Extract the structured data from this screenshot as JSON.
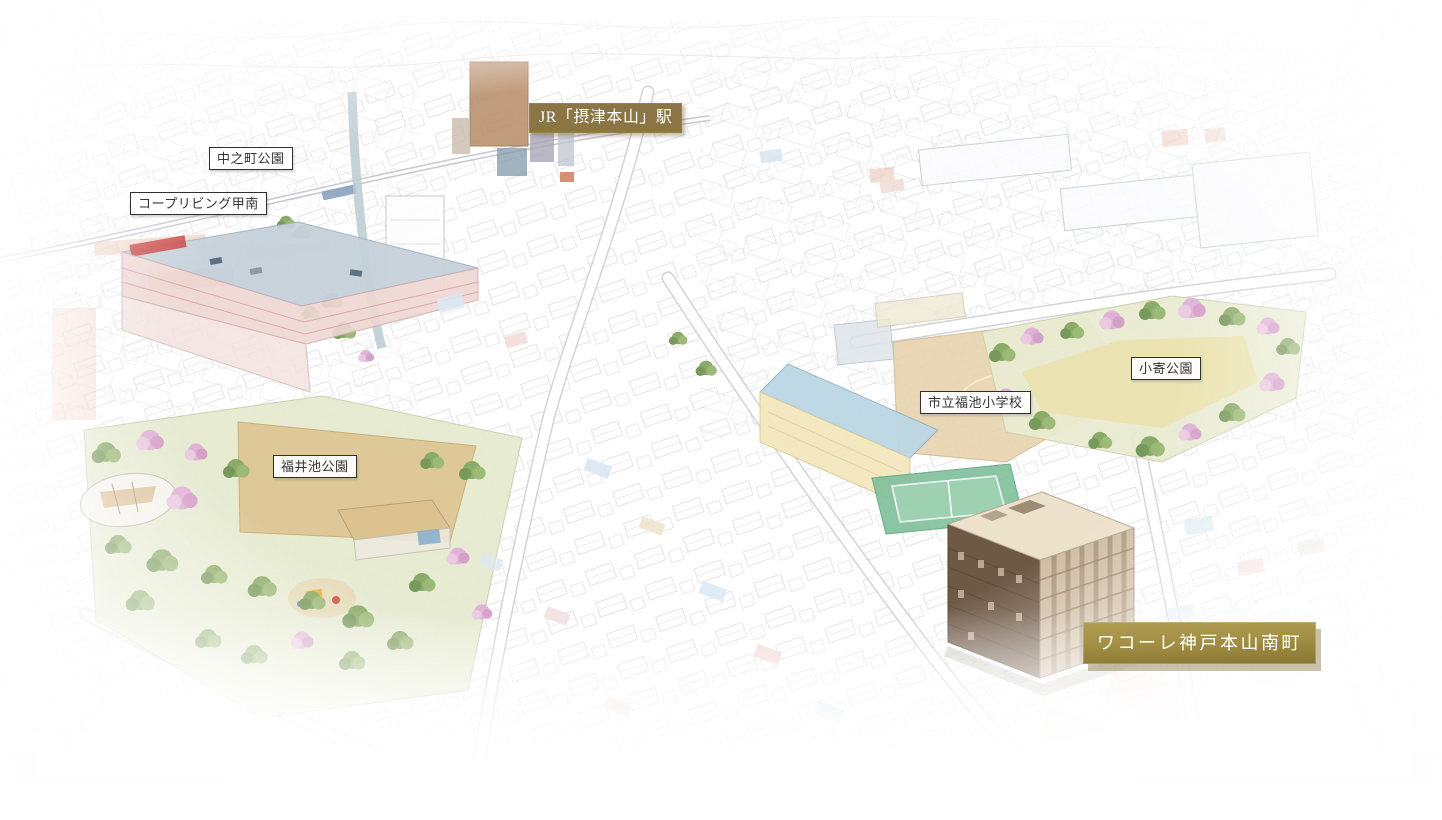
{
  "labels": {
    "station": {
      "text": "JR「摂津本山」駅"
    },
    "nakanocho_park": {
      "text": "中之町公園"
    },
    "coop_living_konan": {
      "text": "コープリビング甲南"
    },
    "koyori_park": {
      "text": "小寄公園"
    },
    "fukuike_elementary": {
      "text": "市立福池小学校"
    },
    "fukuiike_park": {
      "text": "福井池公園"
    },
    "property": {
      "text": "ワコーレ神戸本山南町"
    }
  },
  "colors": {
    "station_badge_bg": "#8b7544",
    "hero_badge_gold_light": "#b09d50",
    "hero_badge_gold_dark": "#887632",
    "label_border": "#2f2f2f",
    "label_text": "#333333",
    "property_building_wall": "#6e5947",
    "park_green": "#8bab68",
    "blossom_pink": "#dfb3d6"
  }
}
